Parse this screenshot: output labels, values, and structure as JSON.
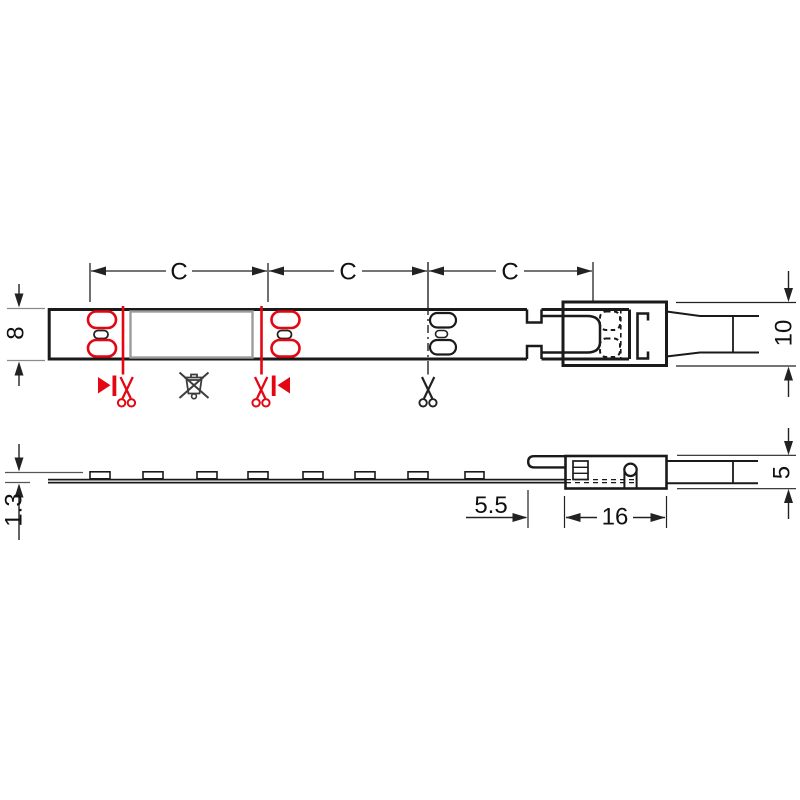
{
  "drawing": {
    "type": "technical-drawing-led-strip",
    "background": "#ffffff",
    "colors": {
      "outline_black": "#1a1a1a",
      "dimension_line": "#222222",
      "cut_mark_red": "#e30613",
      "module_gray": "#9c9c9c",
      "weee_symbol_gray": "#3d3d3d",
      "extension_gray": "#8b8b8b"
    },
    "labels": {
      "pitch": [
        "C",
        "C",
        "C"
      ],
      "strip_width": "8",
      "connector_width": "10",
      "strip_thickness": "1.3",
      "end_offset": "5.5",
      "connector_length": "16",
      "connector_height": "5"
    },
    "icons": [
      "cut-direction-right-icon",
      "scissors-red-left-icon",
      "weee-crossed-bin-icon",
      "scissors-red-right-icon",
      "cut-direction-left-icon",
      "scissors-black-icon"
    ],
    "views": {
      "top": "LED strip top view with solder pads, cut marks and clip connector",
      "side": "LED strip side view with LED chips, clip connector and lead"
    }
  }
}
